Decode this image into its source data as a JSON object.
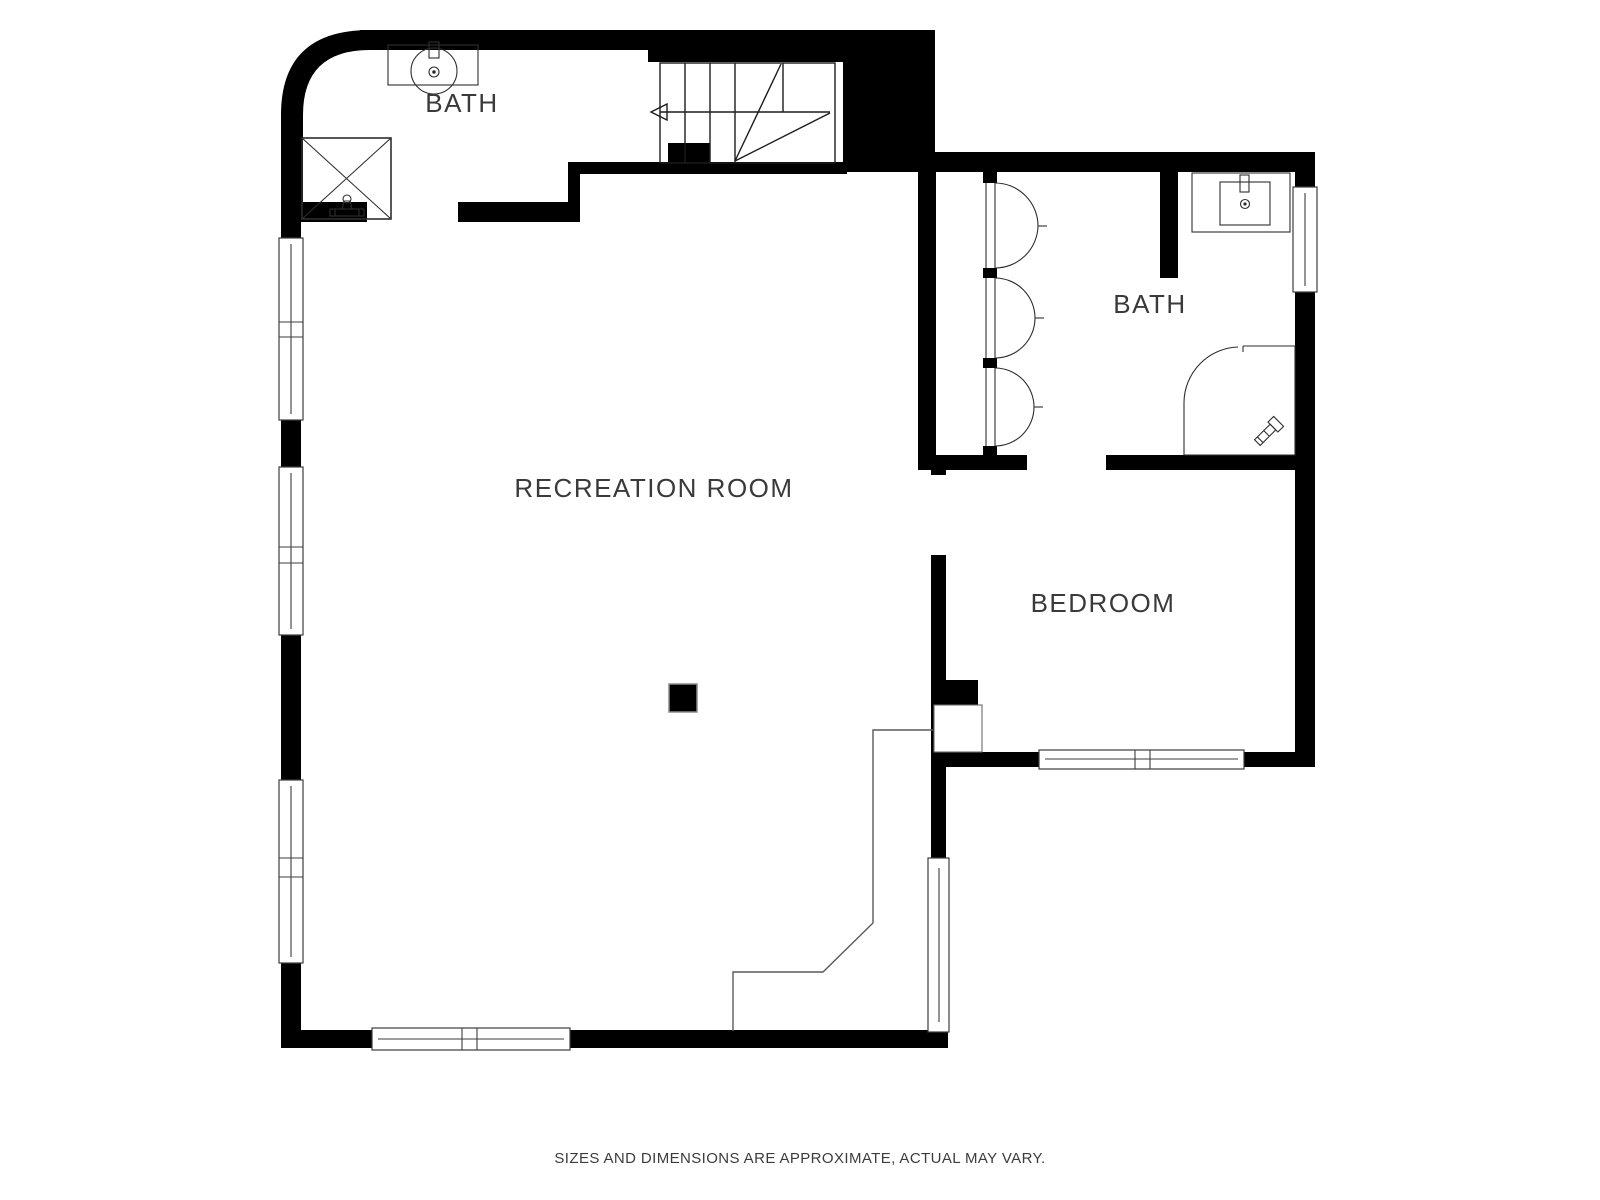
{
  "meta": {
    "type": "floor-plan",
    "disclaimer": "SIZES AND DIMENSIONS ARE APPROXIMATE, ACTUAL MAY VARY."
  },
  "colors": {
    "background": "#ffffff",
    "walls": "#000000",
    "fixture_lines": "#2e2e2e",
    "window_lines": "#3d3d3d",
    "step_line": "#5a5a5a",
    "text": "#3a3a3a"
  },
  "rooms": [
    {
      "id": "bath-upper-left",
      "label": "BATH"
    },
    {
      "id": "bath-right",
      "label": "BATH"
    },
    {
      "id": "recreation-room",
      "label": "RECREATION ROOM"
    },
    {
      "id": "bedroom",
      "label": "BEDROOM"
    }
  ],
  "fixtures": [
    "sink-with-vanity (upper-left bath)",
    "shower-with-x (upper-left bath)",
    "winder-staircase-with-up-arrow",
    "bifold-closet-doors (right bath)",
    "sink-with-vanity (right bath)",
    "corner-shower (right bath)",
    "structural-column (recreation room)",
    "windows (left wall x3, bottom wall, bedroom wall, side walls)"
  ]
}
